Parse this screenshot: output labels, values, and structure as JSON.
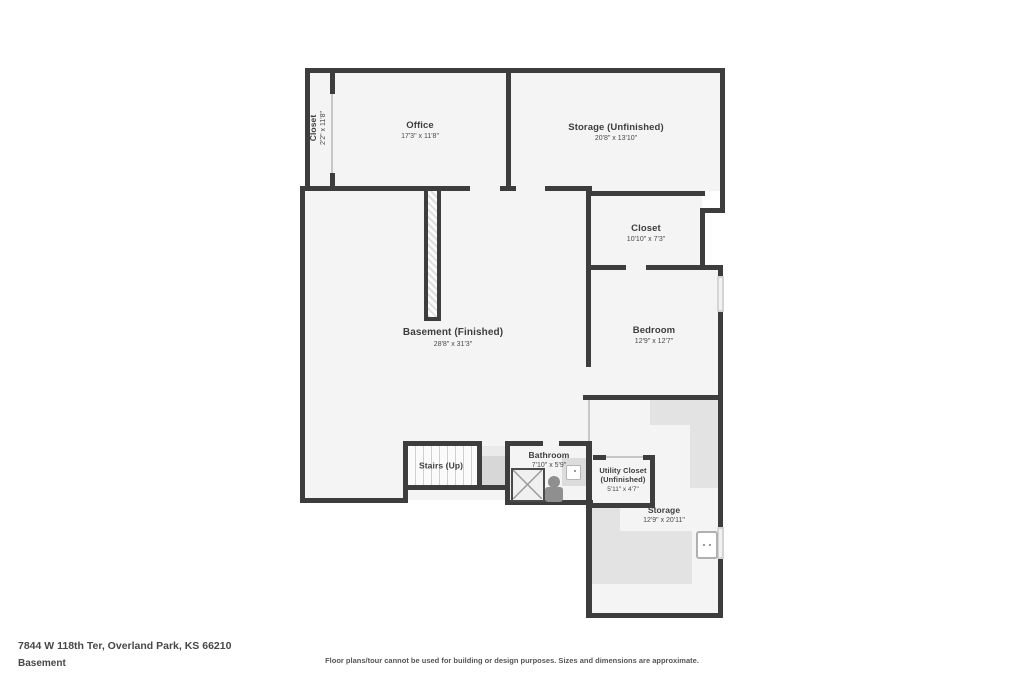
{
  "footer": {
    "address": "7844 W 118th Ter, Overland Park, KS 66210",
    "floor": "Basement",
    "disclaimer": "Floor plans/tour cannot be used for building or design purposes. Sizes and dimensions are approximate."
  },
  "rooms": {
    "closet_left": {
      "name": "Closet",
      "dims": "2'2\" x 11'8\""
    },
    "office": {
      "name": "Office",
      "dims": "17'3\" x 11'8\""
    },
    "storage_unfinished": {
      "name": "Storage (Unfinished)",
      "dims": "20'8\" x 13'10\""
    },
    "closet": {
      "name": "Closet",
      "dims": "10'10\" x 7'3\""
    },
    "basement": {
      "name": "Basement (Finished)",
      "dims": "28'8\" x 31'3\""
    },
    "bedroom": {
      "name": "Bedroom",
      "dims": "12'9\" x 12'7\""
    },
    "stairs": {
      "name": "Stairs (Up)"
    },
    "bathroom": {
      "name": "Bathroom",
      "dims": "7'10\" x 5'9\""
    },
    "utility_closet": {
      "name": "Utility Closet",
      "qualifier": "(Unfinished)",
      "dims": "5'11\" x 4'7\""
    },
    "storage": {
      "name": "Storage",
      "dims": "12'9\" x 20'11\""
    }
  },
  "colors": {
    "wall": "#3d3d3d",
    "room_fill": "#f4f4f4",
    "landing": "#d7d7d7",
    "text": "#3e3e3e"
  }
}
